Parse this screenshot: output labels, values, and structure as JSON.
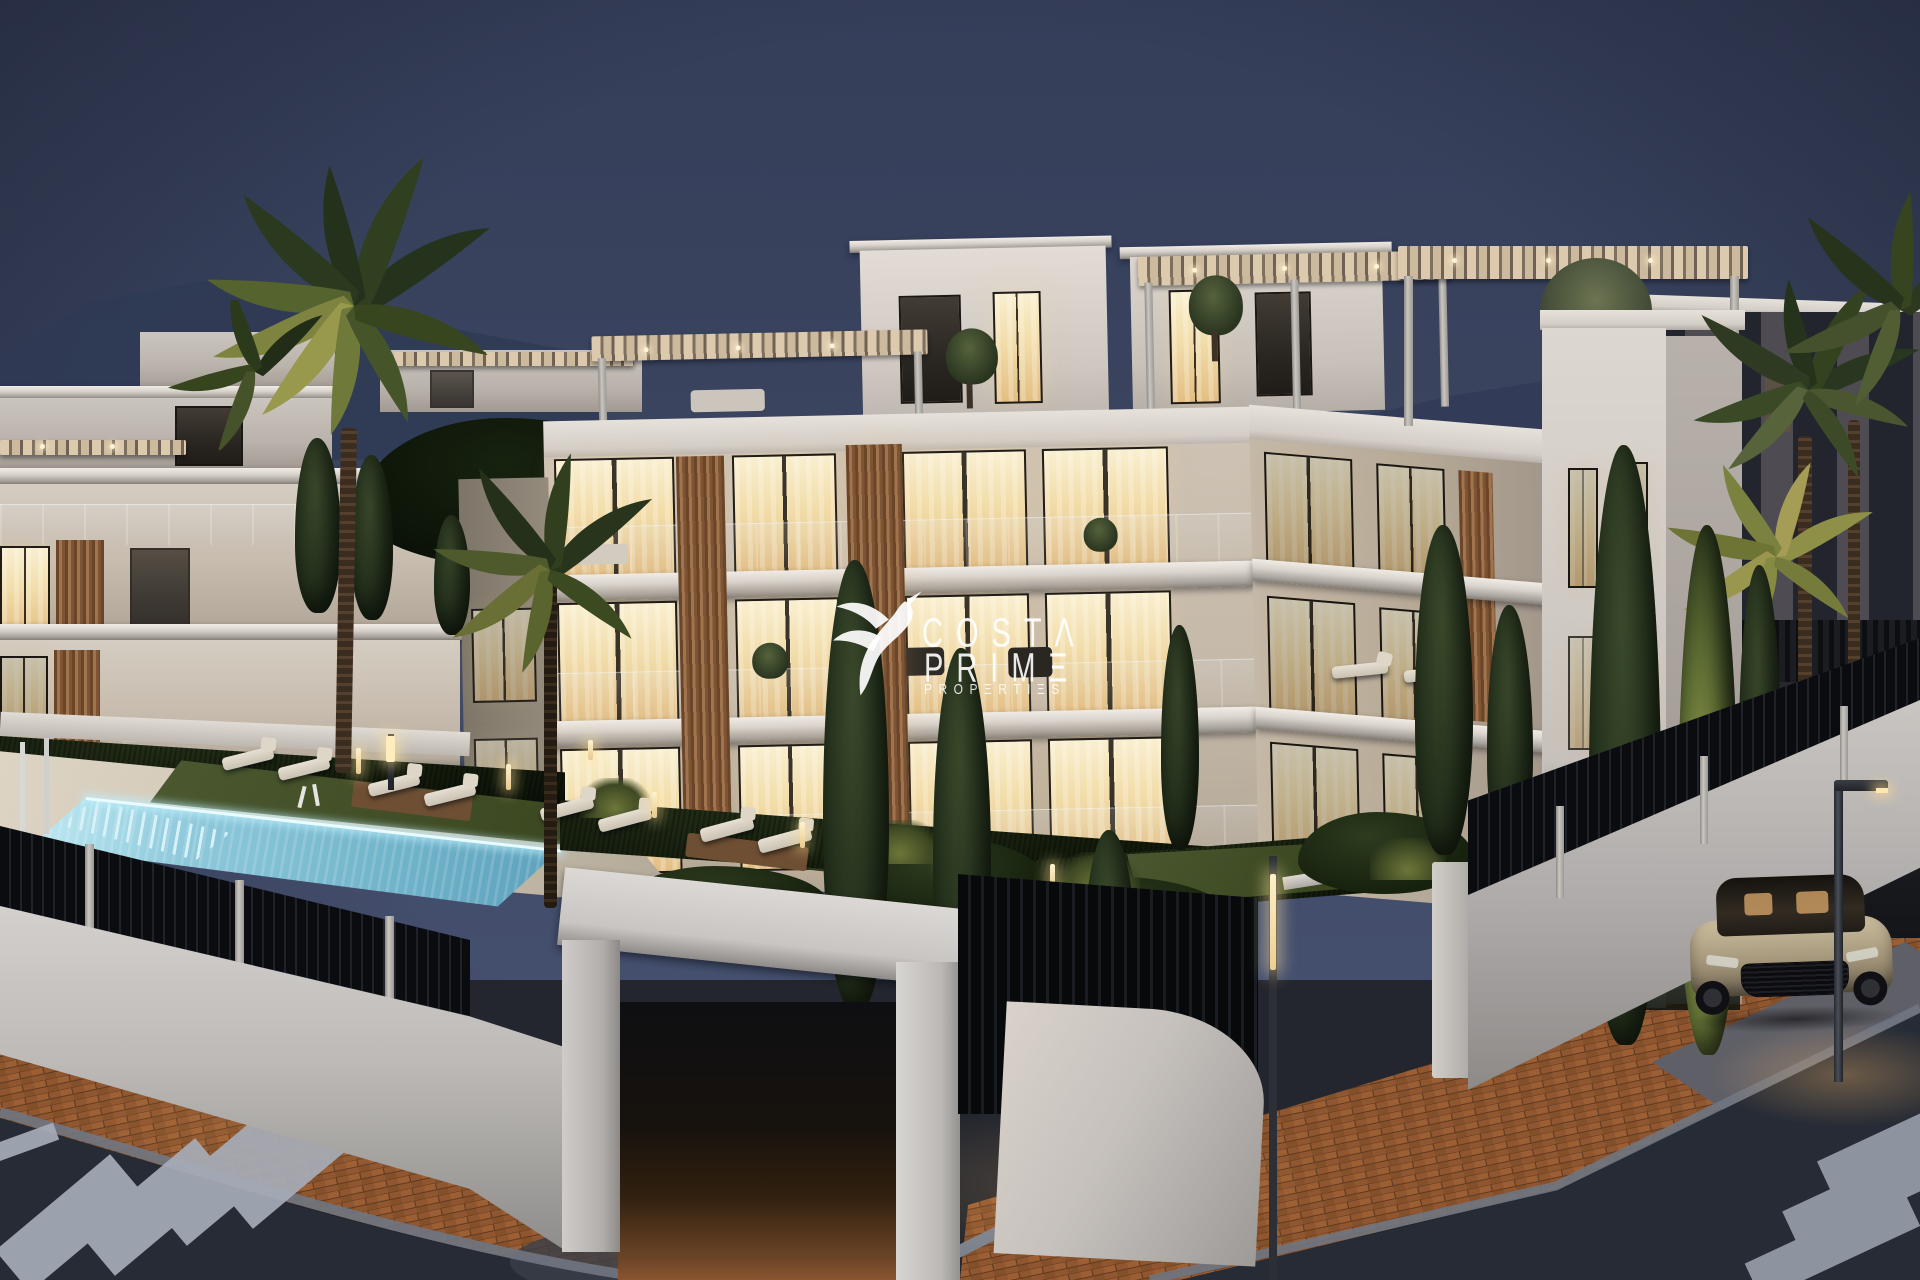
{
  "watermark": {
    "brand": "Costa Prime Properties",
    "line1": "COSTΛ",
    "line2": "PRIMΞ",
    "line3": "PROPΞRTIΞS"
  },
  "scene": {
    "description": "Dusk architectural rendering of a modern white apartment complex with glowing windows, rooftop pergolas, pool with sun loungers, palm and cypress trees, black slat perimeter fence, brick sidewalks, street corner with zebra crosswalks, a parked coupe and street lamps",
    "time_of_day": "dusk",
    "palette": {
      "sky_top": "#353e59",
      "sky_horizon": "#4a5474",
      "facade_light": "#d9d0c4",
      "window_glow": "#f2ddab",
      "wood_slats": "#8a6144",
      "pool_water": "#7fbcd2",
      "pool_rim_glow": "#e8fbff",
      "hedge": "#131b0c",
      "cypress": "#25321d",
      "lawn": "#3d4823",
      "fence_black": "#0e1013",
      "wall_white": "#cfccc9",
      "brick_paving": "#8f5630",
      "asphalt": "#262b35",
      "crosswalk_stripe": "#a7adb8",
      "car_body": "#b3a384",
      "lamp_light": "#ffe6b0"
    },
    "counts": {
      "garden_sun_loungers": 8,
      "terrace_sun_loungers": 2,
      "crosswalk_stripes_left": 5,
      "crosswalk_stripes_right": 3,
      "palm_trees": 6,
      "cypress_trees": 12
    }
  }
}
